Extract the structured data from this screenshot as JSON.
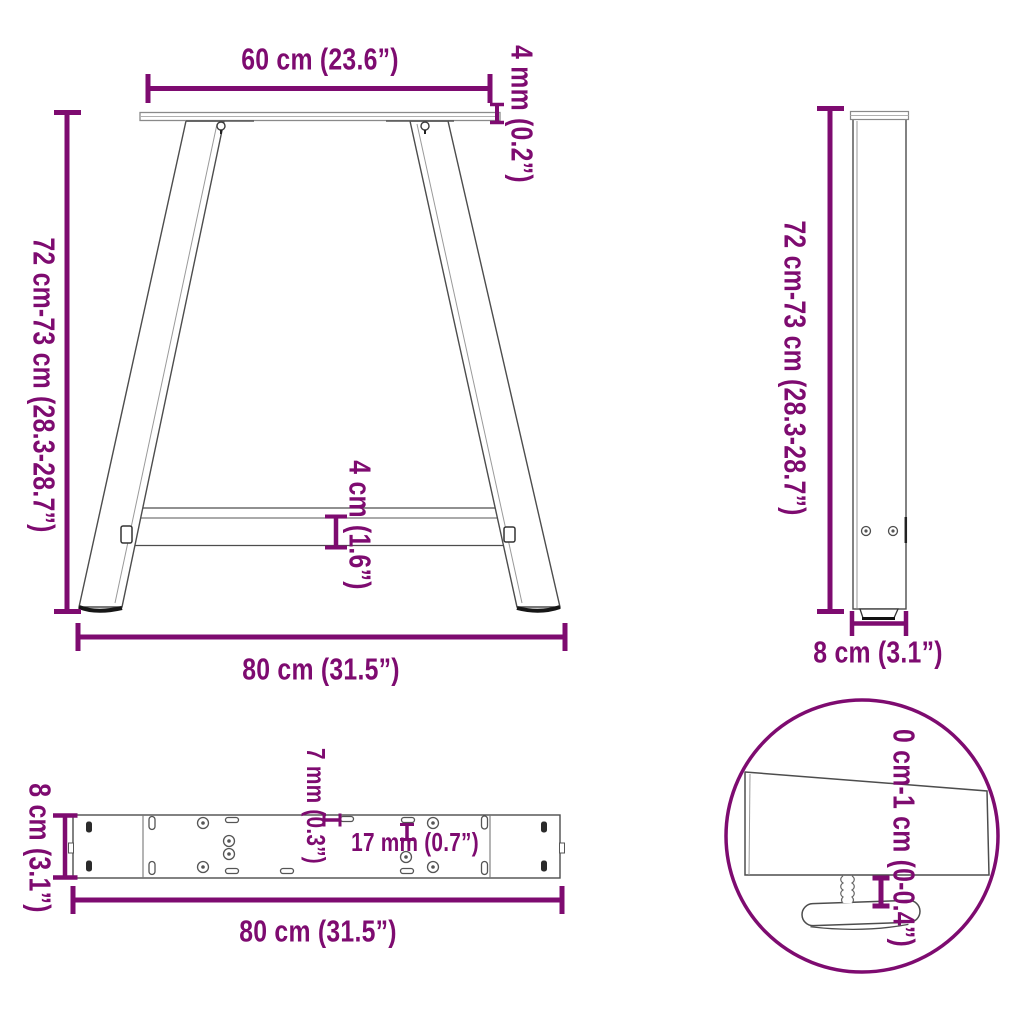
{
  "diagram_title": "A-shaped table legs dimension diagram",
  "colors": {
    "dimension_accent": "#7e0b70",
    "line_art": "#4d4d4d",
    "background": "#ffffff"
  },
  "views": {
    "front_view": "A-frame front view with top plate, two slanted legs and crossbar",
    "side_view": "Leg side profile view",
    "top_view": "Crossbar top view with mounting holes",
    "detail_view": "Magnified circle detail of adjustable foot"
  },
  "labels": {
    "front_top_width": "60 cm (23.6”)",
    "front_plate_thickness": "4 mm (0.2”)",
    "front_height": "72 cm-73 cm (28.3-28.7”)",
    "front_crossbar_height": "4 cm (1.6”)",
    "front_bottom_width": "80 cm (31.5”)",
    "side_height": "72 cm-73 cm (28.3-28.7”)",
    "side_depth": "8 cm (3.1”)",
    "top_depth": "8 cm (3.1”)",
    "top_slot_width": "7 mm (0.3”)",
    "top_hole_diameter": "17 mm (0.7”)",
    "top_length": "80 cm (31.5”)",
    "detail_foot_adjustment": "0 cm-1 cm (0-0.4”)"
  }
}
